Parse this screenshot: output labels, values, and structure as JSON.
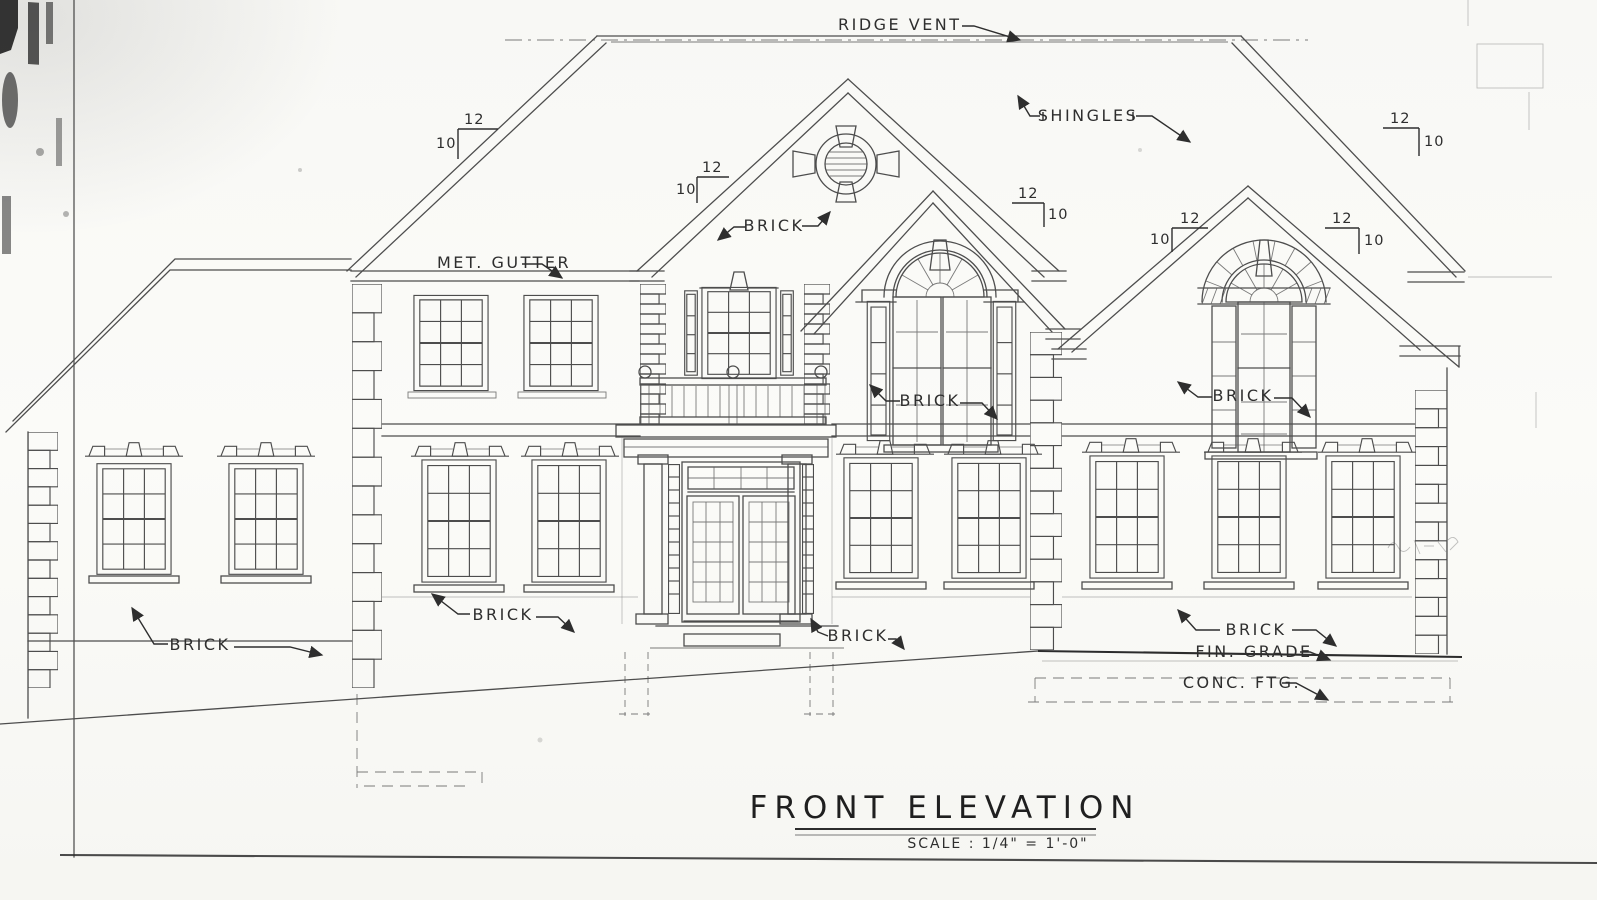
{
  "drawing": {
    "title": "FRONT ELEVATION",
    "scale_note": "SCALE : 1/4\" = 1'-0\"",
    "labels": {
      "ridge_vent": "RIDGE VENT",
      "shingles": "SHINGLES",
      "met_gutter": "MET. GUTTER",
      "brick": "BRICK",
      "fin_grade": "FIN. GRADE",
      "conc_ftg": "CONC. FTG."
    },
    "roof_pitch": {
      "run": "12",
      "rise": "10"
    },
    "colors": {
      "ink": "#4d4d4d",
      "annotation_ink": "#2e2e2e",
      "paper": "#fbfbf8"
    }
  }
}
